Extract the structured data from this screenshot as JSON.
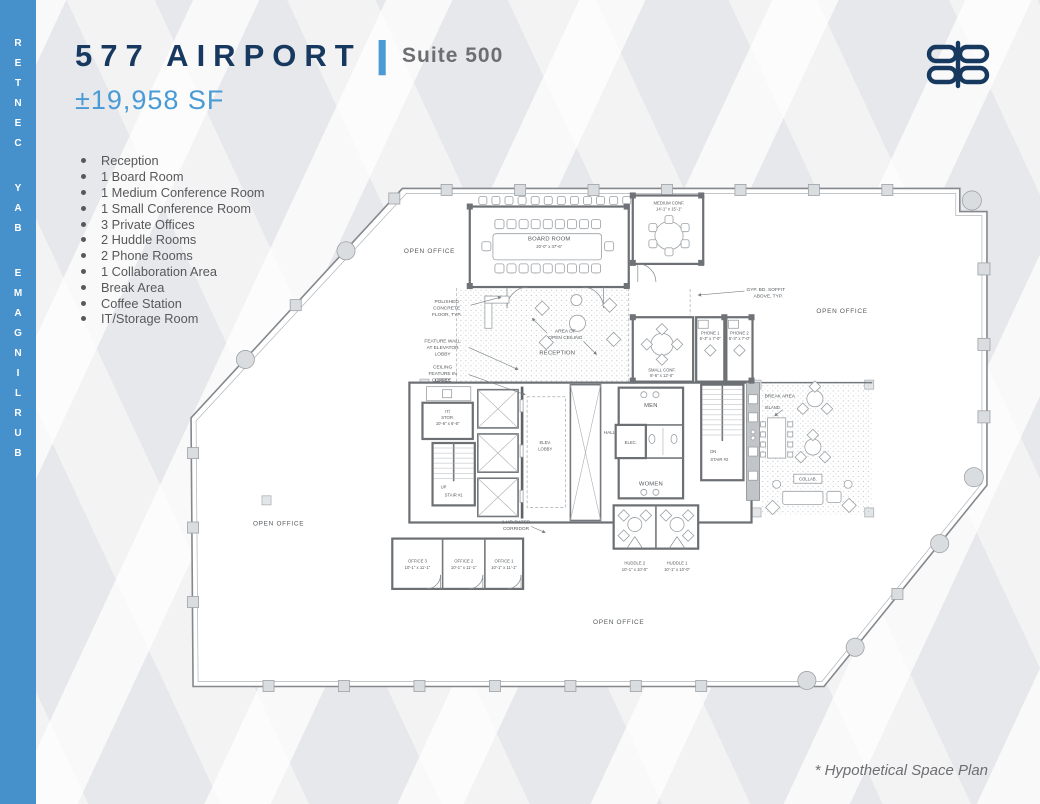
{
  "sidebar": {
    "vertical_text": "BURLINGAME BAY CENTER"
  },
  "header": {
    "building": "577 AIRPORT",
    "divider": "|",
    "suite": "Suite 500",
    "area": "±19,958 SF"
  },
  "logo": {
    "icon": "eb-monogram-icon",
    "color": "#17395f"
  },
  "features": {
    "items": [
      "Reception",
      "1 Board Room",
      "1 Medium Conference Room",
      "1 Small Conference Room",
      "3 Private Offices",
      "2 Huddle Rooms",
      "2 Phone Rooms",
      "1 Collaboration Area",
      "Break Area",
      "Coffee Station",
      "IT/Storage Room"
    ]
  },
  "footnote": "* Hypothetical Space Plan",
  "colors": {
    "sidebar_blue": "#4690cb",
    "navy": "#17395f",
    "accent_blue": "#4a9bd5",
    "gray_text": "#6d6e71",
    "plan_line": "#84888c"
  },
  "plan": {
    "rooms": {
      "board_room": {
        "name": "BOARD ROOM",
        "dims": "20'-0\" x 37'-6\""
      },
      "medium_conf": {
        "name": "MEDIUM CONF.",
        "dims": "14'-1\" x 15'-1\""
      },
      "small_conf": {
        "name": "SMALL CONF.",
        "dims": "8'-6\" x 12'-0\""
      },
      "phone_1": {
        "name": "PHONE 1",
        "dims": "6'-3\" x 7'-0\""
      },
      "phone_2": {
        "name": "PHONE 2",
        "dims": "6'-3\" x 7'-0\""
      },
      "reception": {
        "name": "RECEPTION"
      },
      "coffee": {
        "name": "COFFEE"
      },
      "it_storage": {
        "line1": "IT/",
        "line2": "STOR.",
        "dims": "10'-6\" x 6'-6\""
      },
      "elev_lobby": {
        "line1": "ELEV.",
        "line2": "LOBBY"
      },
      "stair_1": {
        "name": "STAIR #1",
        "direction": "UP"
      },
      "stair_2": {
        "name": "STAIR #2",
        "direction": "DN"
      },
      "hall": {
        "name": "HALL"
      },
      "men": {
        "name": "MEN"
      },
      "women": {
        "name": "WOMEN"
      },
      "elec": {
        "name": "ELEC."
      },
      "break_area": {
        "name": "BREAK AREA"
      },
      "island": {
        "name": "ISLAND"
      },
      "collab": {
        "name": "COLLAB."
      },
      "office_1": {
        "name": "OFFICE 1",
        "dims": "10'-1\" x 11'-1\""
      },
      "office_2": {
        "name": "OFFICE 2",
        "dims": "10'-1\" x 11'-1\""
      },
      "office_3": {
        "name": "OFFICE 3",
        "dims": "10'-1\" x 11'-1\""
      },
      "huddle_1": {
        "name": "HUDDLE 1",
        "dims": "10'-1\" x 10'-0\""
      },
      "huddle_2": {
        "name": "HUDDLE 2",
        "dims": "10'-1\" x 10'-0\""
      },
      "open_office": {
        "name": "OPEN OFFICE"
      }
    },
    "notes": {
      "polished_concrete": {
        "lines": [
          "POLISHED",
          "CONCRETE",
          "FLOOR, TYP."
        ]
      },
      "feature_wall": {
        "lines": [
          "FEATURE WALL",
          "AT ELEVATOR",
          "LOBBY"
        ]
      },
      "ceiling_feature": {
        "lines": [
          "CEILING",
          "FEATURE IN",
          "LOBBY"
        ]
      },
      "open_ceiling": {
        "lines": [
          "AREA OF",
          "OPEN CEILING"
        ]
      },
      "gyp_soffit": {
        "lines": [
          "GYP. BD. SOFFIT",
          "ABOVE, TYP."
        ]
      },
      "rated_corridor": {
        "lines": [
          "1-HR RATED",
          "CORRIDOR"
        ]
      }
    }
  }
}
